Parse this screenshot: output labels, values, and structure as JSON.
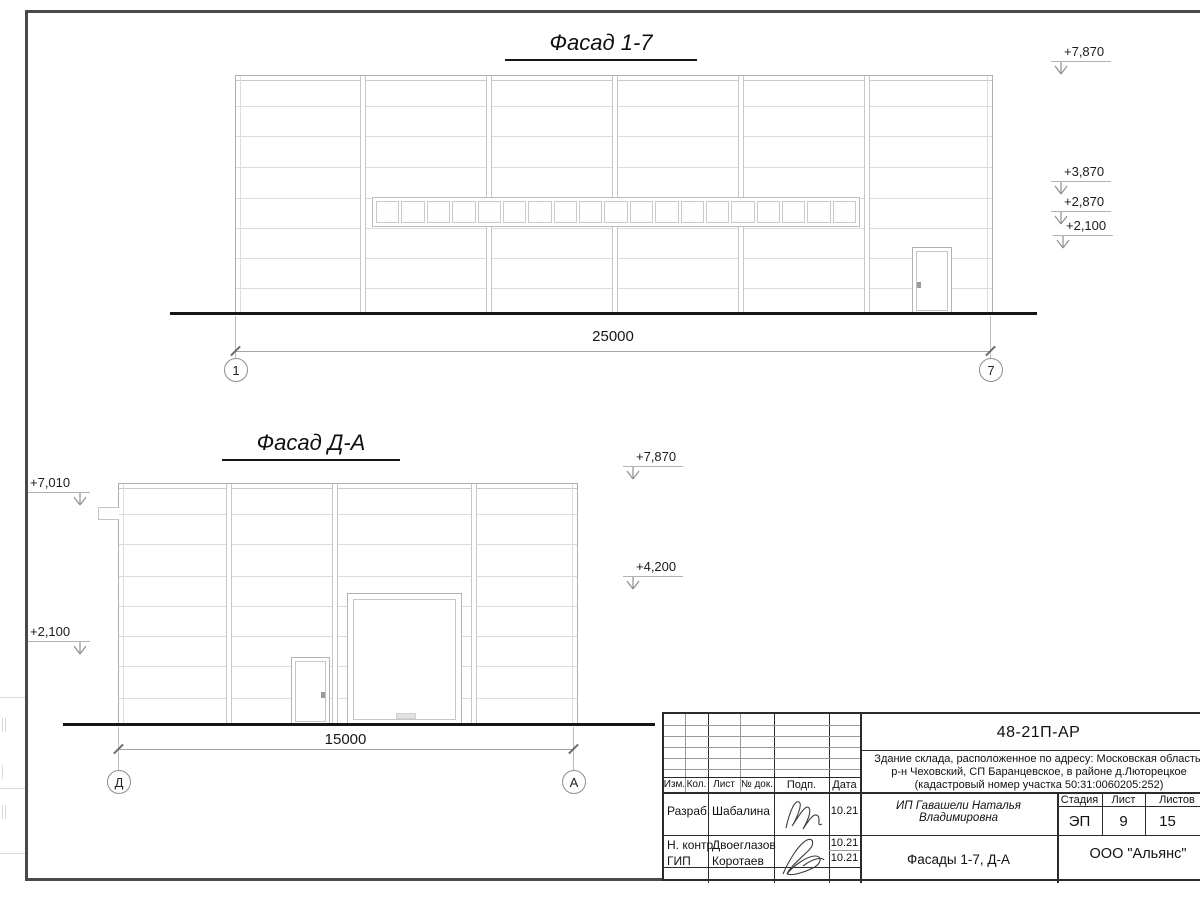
{
  "sheet": {
    "facade17": {
      "title": "Фасад 1-7",
      "dimension": "25000",
      "axes": {
        "left": "1",
        "right": "7"
      },
      "levels_right": [
        "+7,870",
        "+3,870",
        "+2,870",
        "+2,100"
      ]
    },
    "facadeDA": {
      "title": "Фасад Д-А",
      "dimension": "15000",
      "axes": {
        "left": "Д",
        "right": "А"
      },
      "levels_left": [
        "+7,010",
        "+2,100"
      ],
      "levels_right": [
        "+7,870",
        "+4,200"
      ]
    },
    "titleblock": {
      "doc_number": "48-21П-АР",
      "description_line1": "Здание склада, расположенное по адресу: Московская область,",
      "description_line2": "р-н Чеховский, СП Баранцевское, в районе д.Люторецкое",
      "description_line3": "(кадастровый номер участка 50:31:0060205:252)",
      "rev_headers": {
        "izm": "Изм.",
        "kol": "Кол.",
        "list": "Лист",
        "doc": "№ док.",
        "podp": "Подп.",
        "data": "Дата"
      },
      "signature_rows": [
        {
          "role": "Разраб.",
          "name": "Шабалина",
          "date": "10.21"
        },
        {
          "role": "Н. контр.",
          "name": "Двоеглазов",
          "date": "10.21"
        },
        {
          "role": "ГИП",
          "name": "Коротаев",
          "date": "10.21"
        }
      ],
      "client": "ИП Гавашели Наталья Владимировна",
      "stage": {
        "label": "Стадия",
        "value": "ЭП"
      },
      "sheet_no": {
        "label": "Лист",
        "value": "9"
      },
      "sheets_total": {
        "label": "Листов",
        "value": "15"
      },
      "drawing_title": "Фасады 1-7, Д-А",
      "company": "ООО \"Альянс\""
    }
  }
}
